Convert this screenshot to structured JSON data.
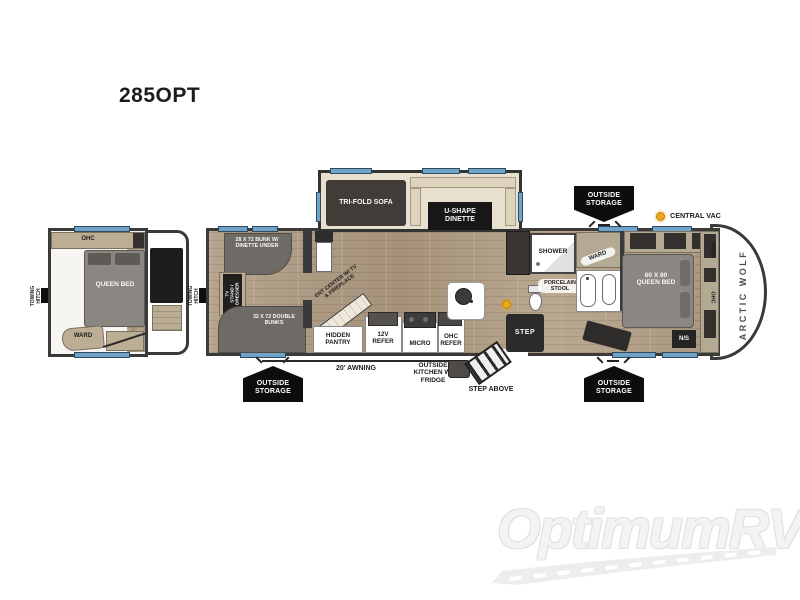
{
  "title": "285OPT",
  "brand": "ARCTIC WOLF",
  "watermark": "OptimumRV",
  "colors": {
    "wood": "#b09e87",
    "wall": "#3a3a3a",
    "window_blue": "#6fa3c8",
    "furniture_gray": "#6e6a65",
    "cream": "#e9e1cf",
    "cabinet_tan": "#bcae95",
    "badge_black": "#0d0d0d",
    "central_vac_yellow": "#eda71c"
  },
  "inset": {
    "towing_hitch": "TOWING HITCH",
    "ohc": "OHC",
    "queen_bed": "QUEEN BED",
    "ward": "WARD"
  },
  "main": {
    "towing_hitch": "TOWING HITCH",
    "tri_fold_sofa": "TRI-FOLD SOFA",
    "u_shape_dinette": "U-SHAPE DINETTE",
    "bunk": "28 X 72 BUNK W/ DINETTE UNDER",
    "tv_stand": "TV STAND / DRESSER",
    "double_bunks": "32 X 72 DOUBLE BUNKS",
    "ent_center": "ENT CENTER W/ TV & FIREPLACE",
    "hidden_pantry": "HIDDEN PANTRY",
    "refer_12v": "12V REFER",
    "micro": "MICRO",
    "ohc_refer": "OHC REFER",
    "shower": "SHOWER",
    "porcelain_stool": "PORCELAIN STOOL",
    "ward_bath": "WARD",
    "step": "STEP",
    "queen_bed": "60 X 80 QUEEN BED",
    "night_stand": "N/S",
    "ward_bedroom": "WARD",
    "ohc_bedroom": "OHC",
    "central_vac": "CENTRAL VAC"
  },
  "annotations": {
    "outside_storage": "OUTSIDE STORAGE",
    "awning": "20' AWNING",
    "outside_kitchen": "OUTSIDE KITCHEN W/ FRIDGE",
    "step_above": "STEP ABOVE"
  }
}
